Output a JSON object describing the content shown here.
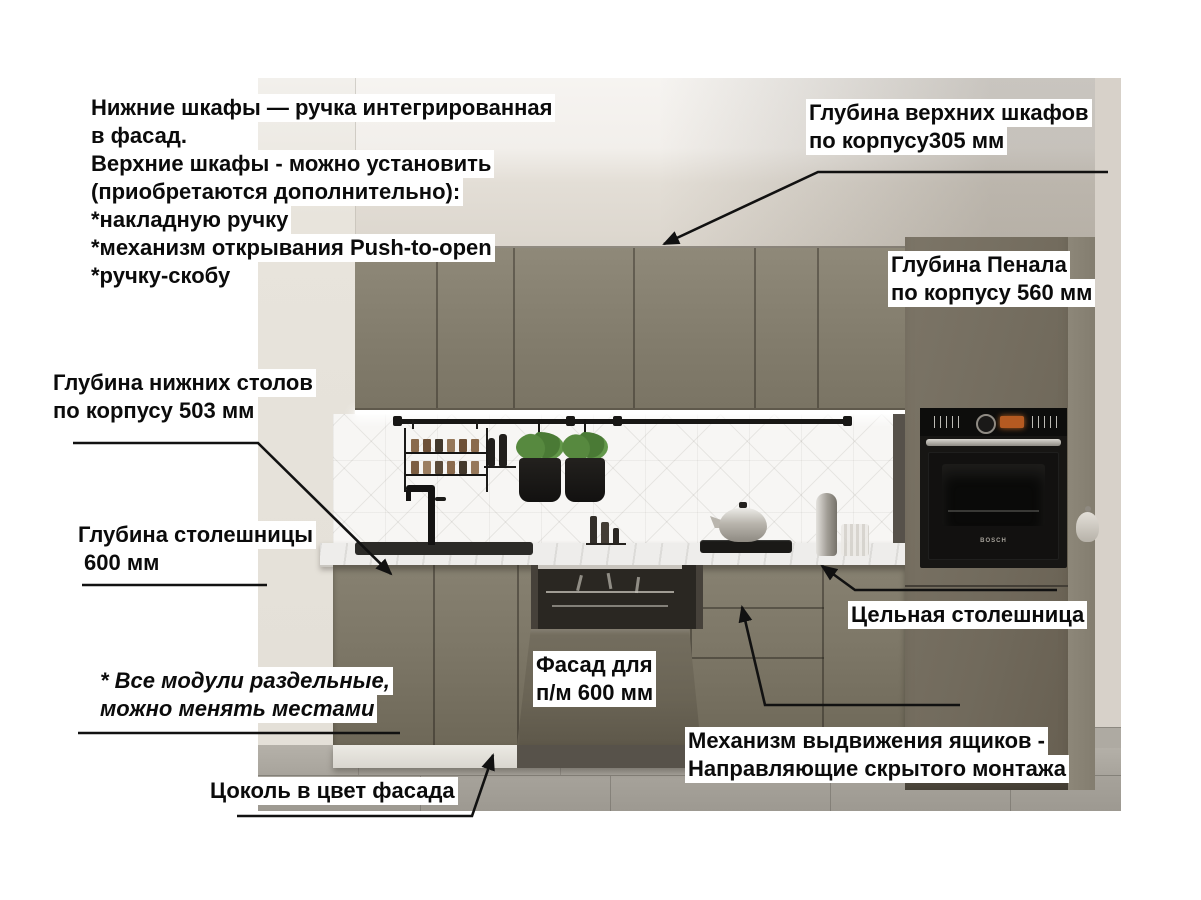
{
  "annotations": {
    "handles_note": {
      "lines": [
        "Нижние шкафы — ручка интегрированная",
        "в фасад.",
        "Верхние шкафы - можно установить",
        "(приобретаются дополнительно):",
        "*накладную ручку",
        "*механизм открывания Push-to-open",
        "*ручку-скобу"
      ]
    },
    "upper_cabinet_depth": {
      "lines": [
        "Глубина верхних шкафов",
        "по корпусу305 мм"
      ]
    },
    "pantry_depth": {
      "lines": [
        "Глубина Пенала",
        "по корпусу 560 мм"
      ]
    },
    "base_cabinet_depth": {
      "lines": [
        "Глубина нижних столов",
        "по корпусу 503 мм"
      ]
    },
    "countertop_depth": {
      "lines": [
        "Глубина столешницы",
        "600 мм"
      ]
    },
    "dishwasher_facade": {
      "lines": [
        "Фасад для",
        "п/м 600 мм"
      ]
    },
    "solid_countertop": {
      "label": "Цельная столешница"
    },
    "drawer_mechanism": {
      "lines": [
        "Механизм выдвижения ящиков -",
        "Направляющие скрытого монтажа"
      ]
    },
    "modules_note": {
      "lines": [
        "* Все модули раздельные,",
        "можно менять местами"
      ]
    },
    "plinth_note": {
      "label": "Цоколь в цвет фасада"
    }
  },
  "scene": {
    "oven_brand": "BOSCH"
  },
  "colors": {
    "facade_olive": "#7e7869",
    "countertop_white": "#eeedeb",
    "backsplash_white": "#f7f6f4",
    "wall_beige": "#d6d0c7",
    "floor_gray": "#a9a59d",
    "annotation_text": "#0b0b0b",
    "annotation_bg": "#ffffff",
    "arrow_black": "#111111"
  }
}
